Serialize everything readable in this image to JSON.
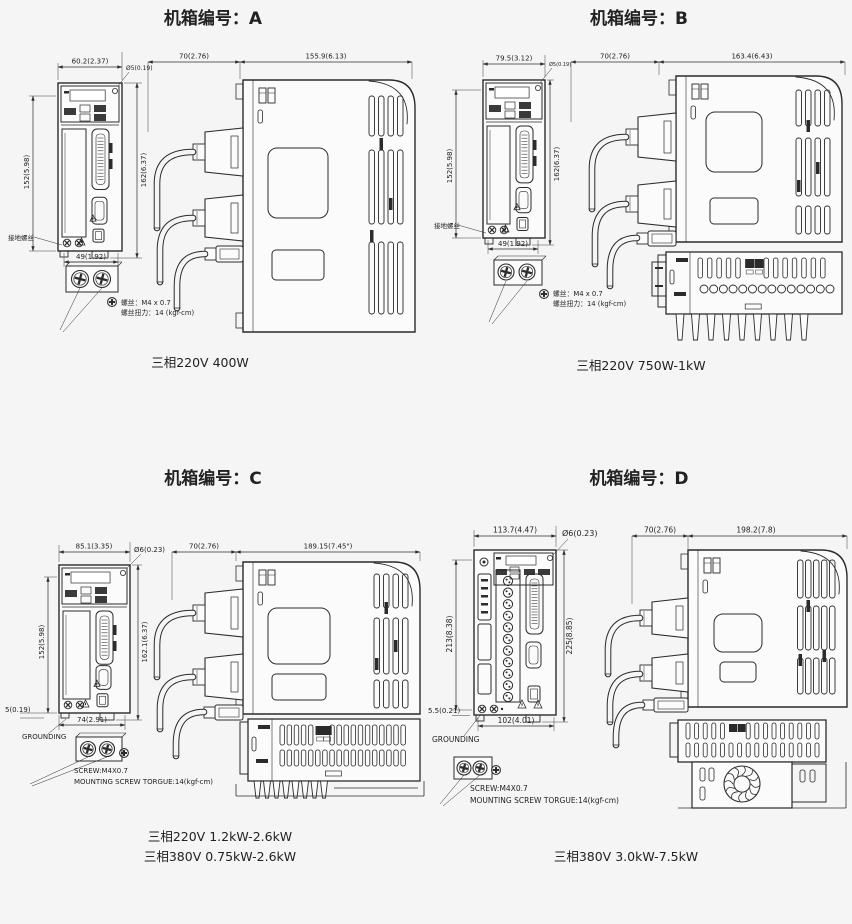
{
  "page": {
    "background": "#f5f5f6",
    "line_color": "#2b2b2b"
  },
  "panels": [
    {
      "id": "A",
      "title": "机箱编号：A",
      "dims": {
        "width": "60.2(2.37)",
        "hole": "Ø5(0.19)",
        "depth_front": "70(2.76)",
        "depth_body": "155.9(6.13)",
        "height_body": "152(5.98)",
        "height_total": "162(6.37)",
        "bottom_width": "49(1.92)"
      },
      "ground_label": "接地螺丝",
      "screw_note_1": "螺丝：M4 x 0.7",
      "screw_note_2": "螺丝扭力：14 (kgf-cm)",
      "power": [
        "三相220V 400W"
      ]
    },
    {
      "id": "B",
      "title": "机箱编号：B",
      "dims": {
        "width": "79.5(3.12)",
        "hole": "Ø5(0.19)",
        "depth_front": "70(2.76)",
        "depth_body": "163.4(6.43)",
        "height_body": "152(5.98)",
        "height_total": "162(6.37)",
        "bottom_width": "49(1.92)"
      },
      "ground_label": "接地螺丝",
      "screw_note_1": "螺丝：M4 x 0.7",
      "screw_note_2": "螺丝扭力：14 (kgf-cm)",
      "power": [
        "三相220V 750W-1kW"
      ]
    },
    {
      "id": "C",
      "title": "机箱编号：C",
      "dims": {
        "width": "85.1(3.35)",
        "hole": "Ø6(0.23)",
        "depth_front": "70(2.76)",
        "depth_body": "189.15(7.45\")",
        "height_body": "152(5.98)",
        "height_total": "162.1(6.37)",
        "bottom_offset": "5(0.19)",
        "bottom_width": "74(2.91)"
      },
      "ground_label": "GROUNDING",
      "screw_note_1": "SCREW:M4X0.7",
      "screw_note_2": "MOUNTING SCREW TORGUE:14(kgf-cm)",
      "power": [
        "三相220V 1.2kW-2.6kW",
        "三相380V 0.75kW-2.6kW"
      ]
    },
    {
      "id": "D",
      "title": "机箱编号：D",
      "dims": {
        "width": "113.7(4.47)",
        "hole": "Ø6(0.23)",
        "depth_front": "70(2.76)",
        "depth_body": "198.2(7.8)",
        "height_body": "213(8.38)",
        "height_total": "225(8.85)",
        "bottom_offset": "5.5(0.21)",
        "bottom_width": "102(4.01)"
      },
      "ground_label": "GROUNDING",
      "screw_note_1": "SCREW:M4X0.7",
      "screw_note_2": "MOUNTING SCREW TORGUE:14(kgf-cm)",
      "power": [
        "三相380V 3.0kW-7.5kW"
      ]
    }
  ]
}
